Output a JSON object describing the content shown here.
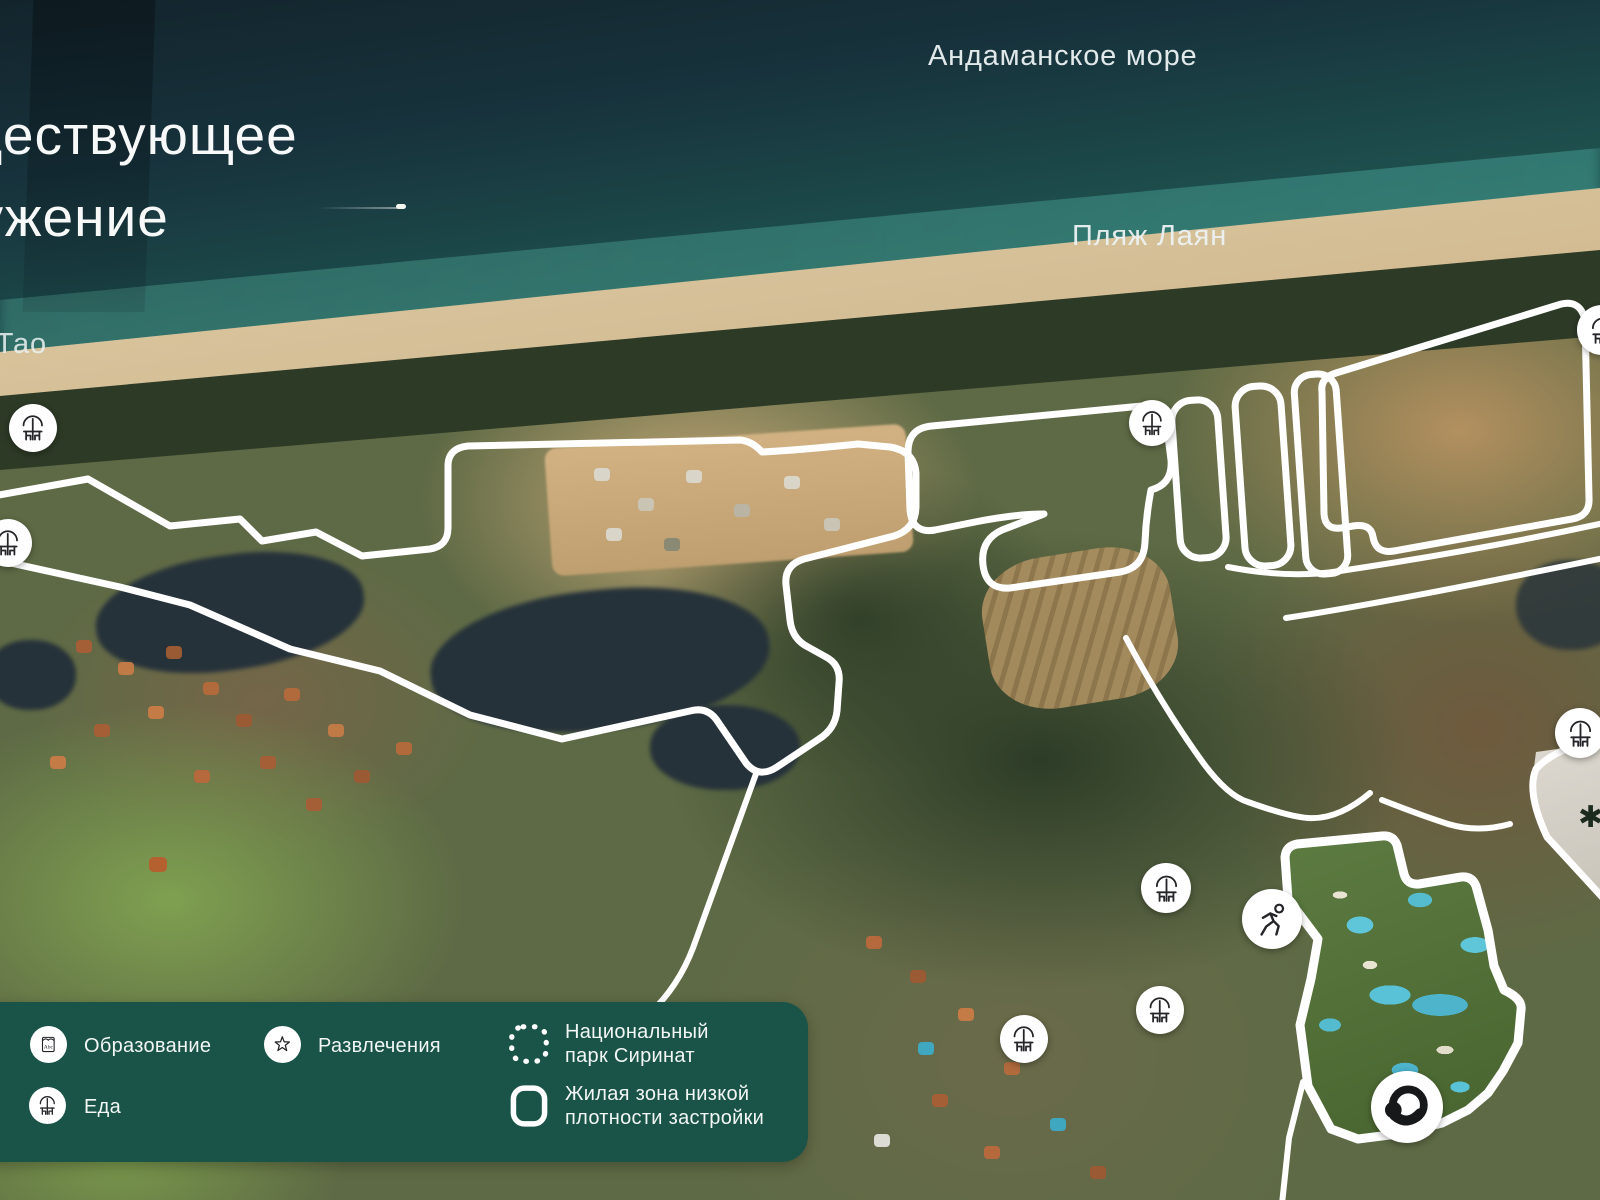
{
  "title": {
    "line1": "Существующее",
    "line2": "окружение"
  },
  "map_labels": {
    "sea": "Андаманское море",
    "beach_right": "Пляж Лаян",
    "beach_left": "Банг Тао"
  },
  "legend": {
    "items": [
      {
        "label": "Образование",
        "icon": "book-abc-icon"
      },
      {
        "label": "Еда",
        "icon": "restaurant-icon"
      },
      {
        "label": "Развлечения",
        "icon": "star-icon"
      }
    ],
    "park": {
      "line1": "Национальный",
      "line2": "парк Сиринат",
      "icon": "dashed-square-icon"
    },
    "zone": {
      "line1": "Жилая зона низкой",
      "line2": "плотности застройки",
      "icon": "rounded-square-icon"
    }
  },
  "markers": [
    {
      "type": "food",
      "icon": "restaurant-icon",
      "x": 33,
      "y": 428,
      "d": 48
    },
    {
      "type": "food",
      "icon": "restaurant-icon",
      "x": 8,
      "y": 543,
      "d": 48
    },
    {
      "type": "food",
      "icon": "restaurant-icon",
      "x": 1152,
      "y": 423,
      "d": 46
    },
    {
      "type": "food",
      "icon": "restaurant-icon",
      "x": 1166,
      "y": 888,
      "d": 50
    },
    {
      "type": "food",
      "icon": "restaurant-icon",
      "x": 1024,
      "y": 1039,
      "d": 48
    },
    {
      "type": "food",
      "icon": "restaurant-icon",
      "x": 1160,
      "y": 1010,
      "d": 48
    },
    {
      "type": "food",
      "icon": "restaurant-icon",
      "x": 1580,
      "y": 733,
      "d": 50
    },
    {
      "type": "food",
      "icon": "restaurant-icon",
      "x": 1602,
      "y": 330,
      "d": 50
    },
    {
      "type": "sport",
      "icon": "running-icon",
      "x": 1272,
      "y": 919,
      "d": 60
    },
    {
      "type": "brand",
      "icon": "brand-logo-icon",
      "x": 1407,
      "y": 1107,
      "d": 72
    }
  ],
  "colors": {
    "legend_panel": "#1a5348",
    "zone_outline": "#ffffff",
    "marker_glyph": "#26262a",
    "sea_deep": "#17323c",
    "sand": "#d8c5a0"
  }
}
